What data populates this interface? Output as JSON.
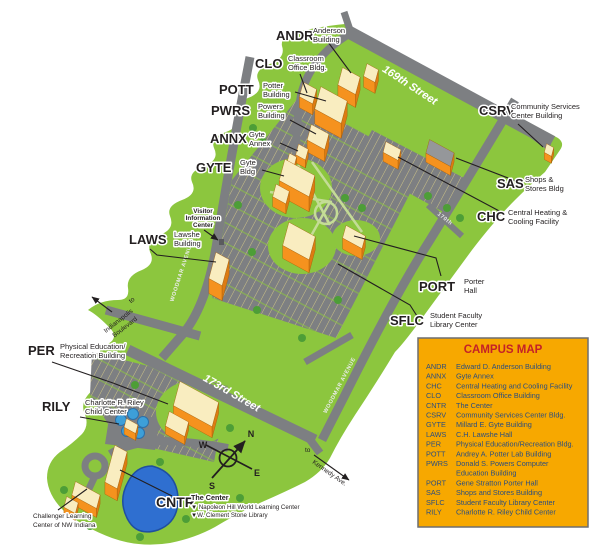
{
  "map_title": "Campus Map",
  "colors": {
    "campus_green": "#8CC63E",
    "road_gray": "#7D7F82",
    "building_orange": "#F5921E",
    "building_roof_cream": "#F9EDC0",
    "sas_roof_gray": "#939598",
    "pond_blue": "#2F6FD0",
    "blue_trees": "#3D9FD8",
    "legend_background": "#F7A800",
    "legend_title_red": "#C42127",
    "legend_text_navy": "#2B4E7E"
  },
  "labels": {
    "andr": {
      "code": "ANDR",
      "l1": "Anderson",
      "l2": "Building"
    },
    "clo": {
      "code": "CLO",
      "l1": "Classroom",
      "l2": "Office Bldg."
    },
    "pott": {
      "code": "POTT",
      "l1": "Potter",
      "l2": "Building"
    },
    "pwrs": {
      "code": "PWRS",
      "l1": "Powers",
      "l2": "Building"
    },
    "annx": {
      "code": "ANNX",
      "l1": "Gyte",
      "l2": "Annex"
    },
    "gyte": {
      "code": "GYTE",
      "l1": "Gyte",
      "l2": "Bldg"
    },
    "csrv": {
      "code": "CSRV",
      "l1": "Community Services",
      "l2": "Center Building"
    },
    "sas": {
      "code": "SAS",
      "l1": "Shops &",
      "l2": "Stores Bldg"
    },
    "chc": {
      "code": "CHC",
      "l1": "Central Heating &",
      "l2": "Cooling Facility"
    },
    "visitor": {
      "l1": "Visitor",
      "l2": "Information",
      "l3": "Center"
    },
    "laws": {
      "code": "LAWS",
      "l1": "Lawshe",
      "l2": "Building"
    },
    "port": {
      "code": "PORT",
      "l1": "Porter",
      "l2": "Hall"
    },
    "sflc": {
      "code": "SFLC",
      "l1": "Student Faculty",
      "l2": "Library Center"
    },
    "per": {
      "code": "PER",
      "l1": "Physical Education/",
      "l2": "Recreation Building"
    },
    "rily": {
      "code": "RILY",
      "l1": "Charlotte R. Riley",
      "l2": "Child Center"
    },
    "cntr": {
      "code": "CNTR",
      "l1": "The Center",
      "l2": "▼ Napoleon Hill World Learning Center",
      "l3": "▼W. Clement Stone Library"
    },
    "challenger": {
      "l1": "Challenger Learning",
      "l2": "Center of NW Indiana"
    }
  },
  "streets": {
    "s169": "169th Street",
    "s173": "173rd Street",
    "woodmar": "WOODMAR AVENUE",
    "woodmar2": "WOODMAR AVENUE",
    "s170": "170th",
    "to1": "to",
    "indy1": "Indianapolis",
    "indy2": "Boulevard",
    "to2": "to",
    "kennedy": "Kennedy Ave."
  },
  "compass": {
    "n": "N",
    "s": "S",
    "e": "E",
    "w": "W"
  },
  "legend": {
    "title": "CAMPUS MAP",
    "entries": [
      {
        "code": "ANDR",
        "name": "Edward D. Anderson Building"
      },
      {
        "code": "ANNX",
        "name": "Gyte Annex"
      },
      {
        "code": "CHC",
        "name": "Central Heating and Cooling Facility"
      },
      {
        "code": "CLO",
        "name": "Classroom Office Building"
      },
      {
        "code": "CNTR",
        "name": "The Center"
      },
      {
        "code": "CSRV",
        "name": "Community Services Center Bldg."
      },
      {
        "code": "GYTE",
        "name": "Millard E. Gyte Building"
      },
      {
        "code": "LAWS",
        "name": "C.H. Lawshe Hall"
      },
      {
        "code": "PER",
        "name": "Physical Education/Recreation Bldg."
      },
      {
        "code": "POTT",
        "name": "Andrey A. Potter Lab Building"
      },
      {
        "code": "PWRS",
        "name": "Donald S. Powers Computer",
        "name2": "Education Building"
      },
      {
        "code": "PORT",
        "name": "Gene Stratton Porter Hall"
      },
      {
        "code": "SAS",
        "name": "Shops and Stores Building"
      },
      {
        "code": "SFLC",
        "name": "Student Faculty Library Center"
      },
      {
        "code": "RILY",
        "name": "Charlotte R. Riley Child Center"
      }
    ]
  }
}
